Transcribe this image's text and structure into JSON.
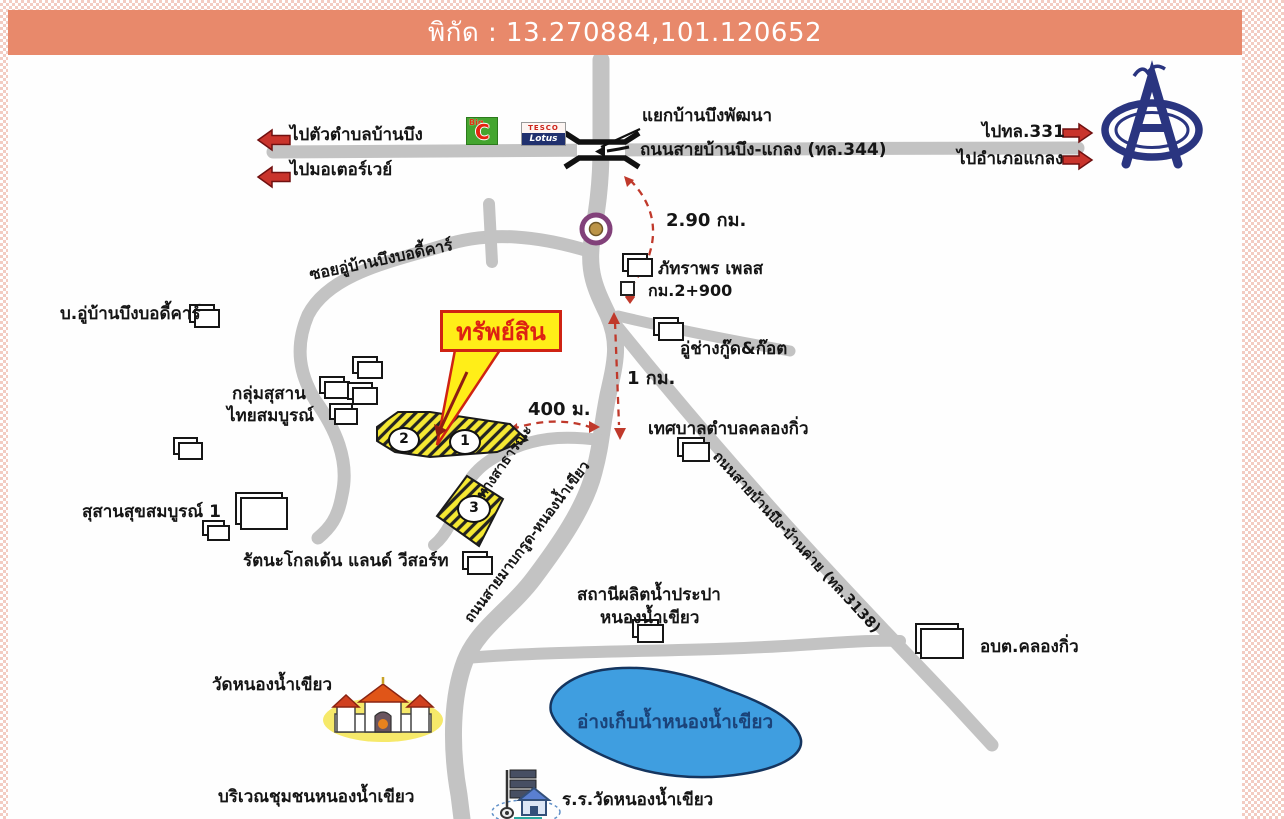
{
  "banner": {
    "text": "พิกัด : 13.270884,101.120652",
    "bg_color": "#E8896B"
  },
  "directions": {
    "to_tambon": "ไปตัวตำบลบ้านบึง",
    "to_motorway": "ไปมอเตอร์เวย์",
    "to_331": "ไปทล.331",
    "to_klaeng": "ไปอำเภอแกลง"
  },
  "junction": {
    "name": "แยกบ้านบึงพัฒนา"
  },
  "roads": {
    "r344": "ถนนสายบ้านบึง-แกลง (ทล.344)",
    "soi": "ซอยอู่บ้านบึงบอดี้คาร์",
    "mabkrut": "ถนนสายมาบกรูด-หนองน้ำเขียว",
    "r3138": "ถนนสายบ้านบึง-บ้านค่าย (ทล.3138)",
    "public_way": "ทางสาธารณะ"
  },
  "distances": {
    "d_290": "2.90 กม.",
    "d_1km": "1 กม.",
    "d_400": "400 ม.",
    "km_marker": "กม.2+900"
  },
  "property": {
    "callout": "ทรัพย์สิน",
    "plot1": "1",
    "plot2": "2",
    "plot3": "3"
  },
  "places": {
    "body_shop": "บ.อู่บ้านบึงบอดี้คาร์",
    "phattraporn": "ภัทราพร เพลส",
    "cemetery_group_l1": "กลุ่มสุสาน",
    "cemetery_group_l2": "ไทยสมบูรณ์",
    "garage": "อู่ช่างกู๊ด&ก๊อต",
    "municipality": "เทศบาลตำบลคลองกิ่ว",
    "cemetery_suk": "สุสานสุขสมบูรณ์ 1",
    "rattana": "รัตนะโกลเด้น แลนด์ วีสอร์ท",
    "water_station_l1": "สถานีผลิตน้ำประปา",
    "water_station_l2": "หนองน้ำเขียว",
    "obt": "อบต.คลองกิ่ว",
    "wat": "วัดหนองน้ำเขียว",
    "lake": "อ่างเก็บน้ำหนองน้ำเขียว",
    "community": "บริเวณชุมชนหนองน้ำเขียว",
    "school": "ร.ร.วัดหนองน้ำเขียว"
  },
  "logos": {
    "bigc_big": "Big",
    "bigc_c": "C",
    "tesco_top": "TESCO",
    "tesco_bottom": "Lotus"
  },
  "colors": {
    "road_gray": "#c3c3c3",
    "plot_yellow": "#f5e833",
    "callout_red": "#cf2313",
    "route_red": "#c0392b",
    "lake_blue": "#3f9ee0",
    "lake_text": "#1b4379",
    "logo_navy": "#2a3580"
  }
}
